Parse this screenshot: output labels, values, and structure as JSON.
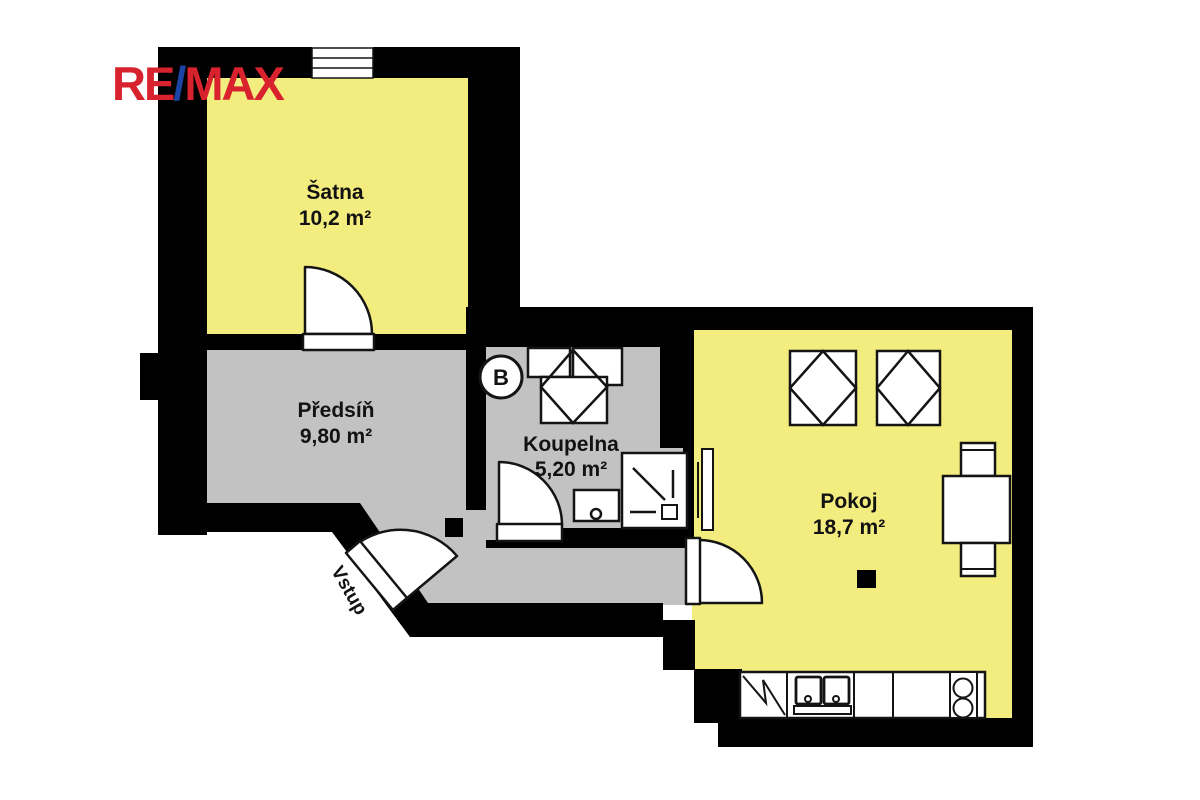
{
  "logo": {
    "re": "RE",
    "slash": "/",
    "max": "MAX"
  },
  "rooms": {
    "satna": {
      "name": "Šatna",
      "area": "10,2 m²"
    },
    "predsin": {
      "name": "Předsíň",
      "area": "9,80 m²"
    },
    "koupelna": {
      "name": "Koupelna",
      "area": "5,20 m²"
    },
    "pokoj": {
      "name": "Pokoj",
      "area": "18,7 m²"
    }
  },
  "labels": {
    "entrance": "Vstup",
    "boiler": "B"
  },
  "colors": {
    "yellow": "#f3ec7e",
    "gray": "#c2c2c2",
    "wall": "#000000",
    "white": "#ffffff",
    "outline": "#141414",
    "text": "#121212",
    "red": "#d8222e",
    "blue": "#1b44a5"
  }
}
